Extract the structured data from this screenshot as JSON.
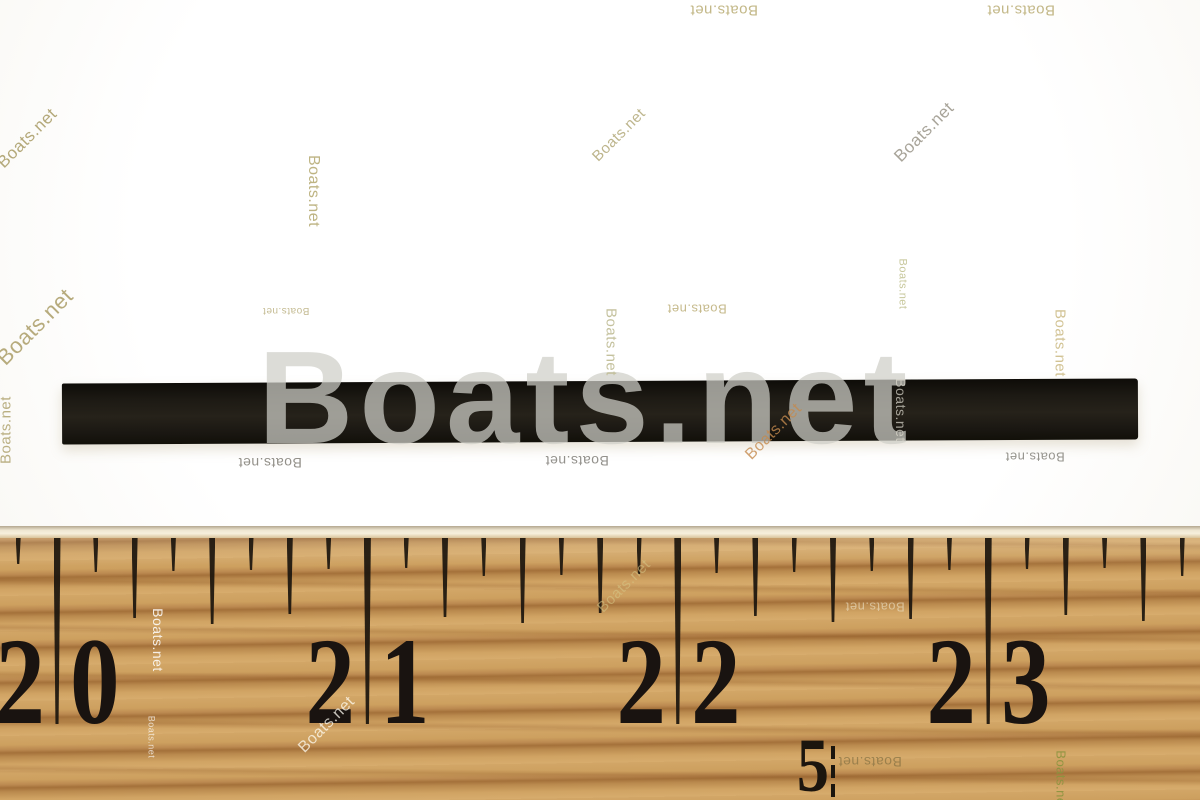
{
  "brand_watermark": "Boats.net",
  "big_watermark": {
    "text": "Boats.net"
  },
  "ruler": {
    "inch_labels": [
      {
        "text": "20",
        "tick_x": 57
      },
      {
        "text": "21",
        "tick_x": 367
      },
      {
        "text": "22",
        "tick_x": 678
      },
      {
        "text": "23",
        "tick_x": 988
      }
    ],
    "half_inch_label": {
      "text": "5",
      "tick_x": 833
    },
    "scale": {
      "inch_start_x": 57,
      "eighth_spacing_px": 38.8,
      "first_index": -1,
      "last_index": 29
    }
  },
  "watermarks": [
    {
      "x": 27,
      "y": 138,
      "rot": -45,
      "size": 17,
      "color": "rgba(172,160,108,0.90)"
    },
    {
      "x": 313,
      "y": 191,
      "rot": 90,
      "size": 16,
      "color": "rgba(186,176,124,0.95)"
    },
    {
      "x": 619,
      "y": 135,
      "rot": -45,
      "size": 15,
      "color": "rgba(178,168,120,0.85)"
    },
    {
      "x": 924,
      "y": 132,
      "rot": -45,
      "size": 17,
      "color": "rgba(158,154,142,0.90)"
    },
    {
      "x": 724,
      "y": 10,
      "rot": 180,
      "size": 15,
      "color": "rgba(192,180,130,0.95)"
    },
    {
      "x": 1021,
      "y": 10,
      "rot": 180,
      "size": 15,
      "color": "rgba(192,180,130,0.95)"
    },
    {
      "x": 902,
      "y": 284,
      "rot": 90,
      "size": 11,
      "color": "rgba(196,196,150,0.95)"
    },
    {
      "x": 1060,
      "y": 343,
      "rot": 90,
      "size": 15,
      "color": "rgba(208,192,142,0.95)"
    },
    {
      "x": 611,
      "y": 342,
      "rot": 90,
      "size": 15,
      "color": "rgba(190,186,146,0.90)"
    },
    {
      "x": 697,
      "y": 309,
      "rot": 180,
      "size": 13,
      "color": "rgba(192,178,128,0.90)"
    },
    {
      "x": 286,
      "y": 310,
      "rot": 180,
      "size": 10,
      "color": "rgba(190,180,134,0.90)"
    },
    {
      "x": 35,
      "y": 327,
      "rot": -45,
      "size": 22,
      "color": "rgba(170,156,102,0.85)"
    },
    {
      "x": 6,
      "y": 430,
      "rot": -90,
      "size": 15,
      "color": "rgba(178,166,116,0.90)"
    },
    {
      "x": 270,
      "y": 463,
      "rot": 180,
      "size": 14,
      "color": "rgba(128,125,116,0.85)"
    },
    {
      "x": 577,
      "y": 461,
      "rot": 180,
      "size": 14,
      "color": "rgba(128,126,120,0.85)"
    },
    {
      "x": 1035,
      "y": 457,
      "rot": 180,
      "size": 13,
      "color": "rgba(132,130,122,0.85)"
    },
    {
      "x": 774,
      "y": 432,
      "rot": -45,
      "size": 16,
      "color": "rgba(196,138,78,0.80)"
    },
    {
      "x": 901,
      "y": 410,
      "rot": 90,
      "size": 14,
      "color": "rgba(222,220,208,0.70)"
    },
    {
      "x": 158,
      "y": 640,
      "rot": 90,
      "size": 14,
      "color": "rgba(255,255,255,0.85)"
    },
    {
      "x": 151,
      "y": 737,
      "rot": 90,
      "size": 9,
      "color": "rgba(255,255,255,0.70)"
    },
    {
      "x": 327,
      "y": 725,
      "rot": -45,
      "size": 16,
      "color": "rgba(255,252,242,0.75)"
    },
    {
      "x": 624,
      "y": 586,
      "rot": -45,
      "size": 15,
      "color": "rgba(214,196,134,0.60)"
    },
    {
      "x": 875,
      "y": 607,
      "rot": 180,
      "size": 13,
      "color": "rgba(238,228,202,0.60)"
    },
    {
      "x": 870,
      "y": 762,
      "rot": 180,
      "size": 14,
      "color": "rgba(112,98,56,0.55)"
    },
    {
      "x": 1061,
      "y": 780,
      "rot": 90,
      "size": 13,
      "color": "rgba(138,148,62,0.90)"
    }
  ],
  "colors": {
    "background": "#fcfbf7",
    "strip_black": "#1a1712",
    "wood_base": "#cfa262",
    "wood_grain_dark": "#a4713a",
    "tick_black": "#1c150e",
    "big_watermark_gray": "rgba(206,206,199,0.72)"
  }
}
